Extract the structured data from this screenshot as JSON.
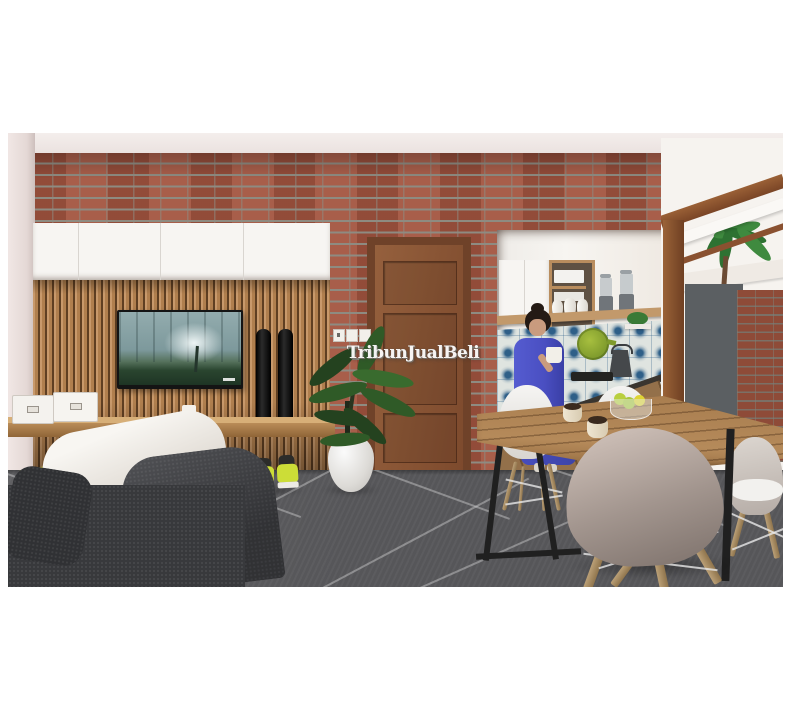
{
  "watermark": {
    "text": "TribunJualBeli"
  },
  "palette": {
    "page_background": "#ffffff",
    "brick": "#a3543f",
    "brick_mortar": "#8e8b81",
    "slat_wood": "#b07f4e",
    "cabinet_white": "#f7f5f2",
    "door_wood": "#8a5538",
    "floor_tile_gray": "#565659",
    "sofa_charcoal": "#3e3f42",
    "cushion_white": "#f0ede8",
    "kitchen_tile_blue": "#2e5f88",
    "person_outfit_blue": "#4a4fc2",
    "table_wood": "#a77c4e",
    "chair_taupe": "#a2958e",
    "plant_green": "#2f5a27",
    "sneaker_yellow": "#ccdd37",
    "tv_screen_teal": "#7d999c",
    "outdoor_wall_gray": "#5b5f62"
  }
}
